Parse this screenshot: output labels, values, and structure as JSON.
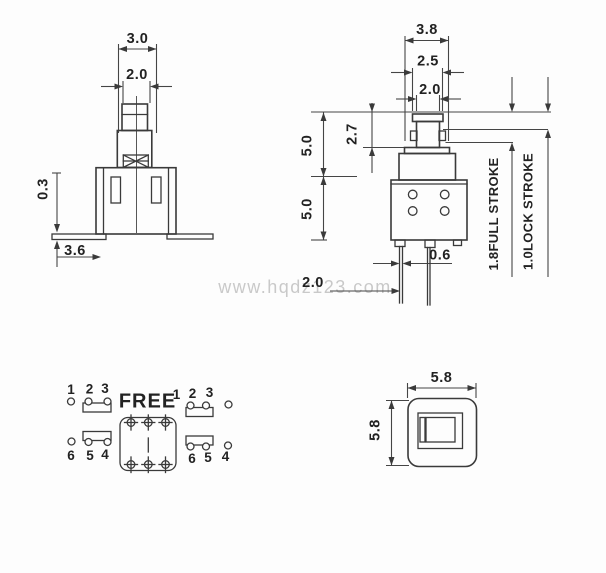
{
  "watermark": "www.hqdz123.com",
  "front_view": {
    "dim_top_width": "3.0",
    "dim_stem_width": "2.0",
    "dim_foot_thickness": "0.3",
    "dim_base_width": "3.6"
  },
  "side_view": {
    "dim_flange_width": "3.8",
    "dim_cap_width": "2.5",
    "dim_neck_width": "2.0",
    "dim_stem_exposed": "2.7",
    "dim_upper_height": "5.0",
    "dim_body_height": "5.0",
    "dim_pin_width": "0.6",
    "dim_pin_offset": "2.0",
    "full_stroke_label": "1.8FULL STROKE",
    "lock_stroke_label": "1.0LOCK STROKE"
  },
  "pinout": {
    "state_label": "FREE",
    "locked": {
      "top": [
        "1",
        "2",
        "3"
      ],
      "bottom": [
        "6",
        "5",
        "4"
      ]
    },
    "free": {
      "top": [
        "1",
        "2",
        "3"
      ],
      "bottom": [
        "6",
        "5",
        "4"
      ]
    }
  },
  "top_view": {
    "dim_width": "5.8",
    "dim_height": "5.8"
  },
  "colors": {
    "line": "#3a3a3a",
    "watermark": "#c9c9c9",
    "background": "#fdfdfd"
  }
}
